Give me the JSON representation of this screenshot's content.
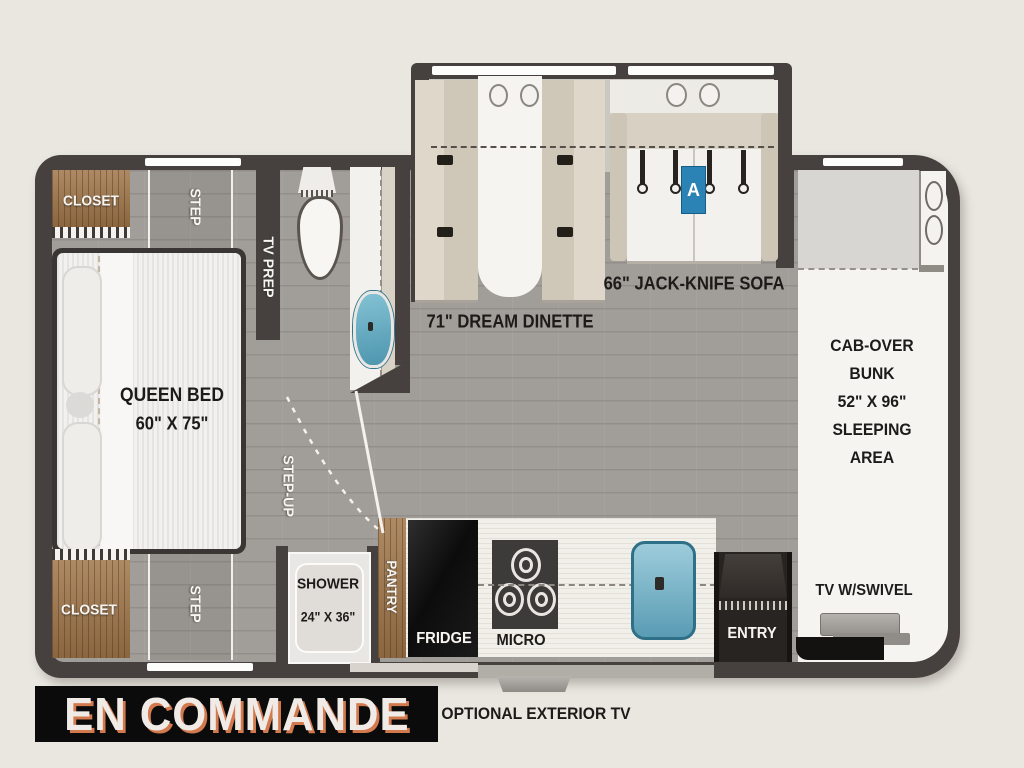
{
  "title_banner": {
    "label": "EN COMMANDE",
    "bg_color": "#0b0b0b",
    "text_color": "#f0ebe7",
    "shadow_color": "#d2794e"
  },
  "exterior_note": {
    "label": "OPTIONAL EXTERIOR TV"
  },
  "bedroom": {
    "closet_top_label": "CLOSET",
    "closet_bottom_label": "CLOSET",
    "step_top_label": "STEP",
    "step_bottom_label": "STEP",
    "tv_prep_label": "TV PREP",
    "bed_label_line1": "QUEEN BED",
    "bed_label_line2": "60\" X 75\""
  },
  "bathroom": {
    "step_up_label": "STEP-UP",
    "shower_label_line1": "SHOWER",
    "shower_label_line2": "24\" X 36\""
  },
  "kitchen": {
    "pantry_label": "PANTRY",
    "fridge_label": "FRIDGE",
    "micro_label": "MICRO"
  },
  "living_area": {
    "dinette_label": "71\" DREAM DINETTE",
    "sofa_label": "66\" JACK-KNIFE SOFA",
    "sofa_position_badge": "A",
    "badge_color": "#2a82b5"
  },
  "cab_area": {
    "bunk_label_lines": [
      "CAB-OVER",
      "BUNK",
      "52\" X 96\"",
      "SLEEPING",
      "AREA"
    ],
    "tv_label": "TV W/SWIVEL",
    "entry_label": "ENTRY"
  },
  "palette": {
    "wall": "#46413e",
    "floor": "#a19d98",
    "wood": "#a0774b",
    "sink_blue": "#5a9cb4",
    "cab_white": "#f5f4f1",
    "background": "#eae7e1"
  }
}
